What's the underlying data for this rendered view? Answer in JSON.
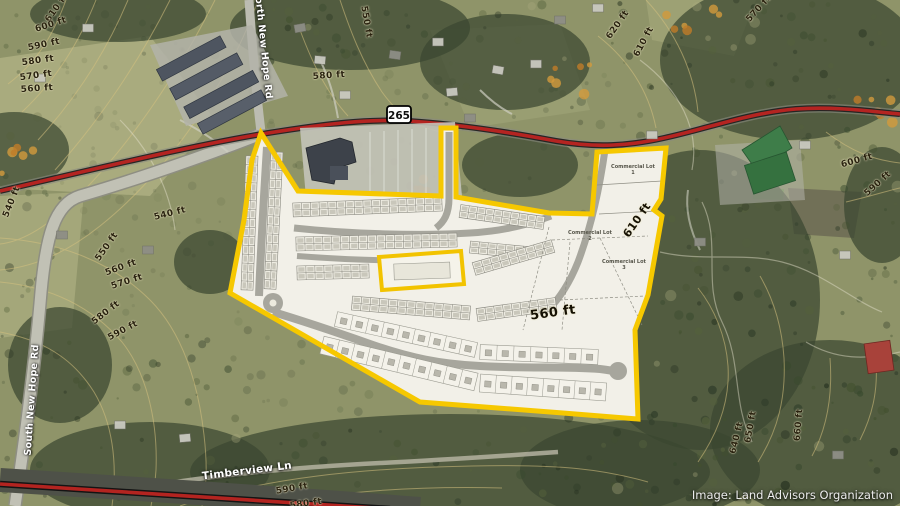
{
  "map": {
    "credit": "Image: Land Advisors Organization",
    "route_shield": {
      "number": "265"
    },
    "road_labels": [
      {
        "text": "North New Hope Rd",
        "x": 263,
        "y": 44,
        "rot": 84
      },
      {
        "text": "South New Hope Rd",
        "x": 32,
        "y": 400,
        "rot": -86
      },
      {
        "text": "Timberview Ln",
        "x": 247,
        "y": 471,
        "rot": -7,
        "size": 10.5
      }
    ],
    "elevation_labels": [
      {
        "text": "610 ft",
        "x": 57,
        "y": 8,
        "rot": -55
      },
      {
        "text": "600 ft",
        "x": 51,
        "y": 25,
        "rot": -18
      },
      {
        "text": "590 ft",
        "x": 44,
        "y": 45,
        "rot": -12
      },
      {
        "text": "580 ft",
        "x": 38,
        "y": 61,
        "rot": -8
      },
      {
        "text": "570 ft",
        "x": 36,
        "y": 76,
        "rot": -8
      },
      {
        "text": "560 ft",
        "x": 37,
        "y": 89,
        "rot": -4
      },
      {
        "text": "550 ft",
        "x": 366,
        "y": 22,
        "rot": 80
      },
      {
        "text": "580 ft",
        "x": 329,
        "y": 76,
        "rot": -4
      },
      {
        "text": "540 ft",
        "x": 12,
        "y": 202,
        "rot": -68
      },
      {
        "text": "540 ft",
        "x": 170,
        "y": 214,
        "rot": -14
      },
      {
        "text": "550 ft",
        "x": 107,
        "y": 247,
        "rot": -55
      },
      {
        "text": "560 ft",
        "x": 121,
        "y": 268,
        "rot": -20
      },
      {
        "text": "570 ft",
        "x": 127,
        "y": 282,
        "rot": -18
      },
      {
        "text": "580 ft",
        "x": 106,
        "y": 313,
        "rot": -38
      },
      {
        "text": "590 ft",
        "x": 123,
        "y": 331,
        "rot": -28
      },
      {
        "text": "620 ft",
        "x": 618,
        "y": 25,
        "rot": -55
      },
      {
        "text": "610 ft",
        "x": 644,
        "y": 42,
        "rot": -62
      },
      {
        "text": "570 ft",
        "x": 759,
        "y": 9,
        "rot": -48
      },
      {
        "text": "600 ft",
        "x": 857,
        "y": 161,
        "rot": -16
      },
      {
        "text": "590 ft",
        "x": 878,
        "y": 184,
        "rot": -42
      },
      {
        "text": "640 ft",
        "x": 737,
        "y": 438,
        "rot": -76
      },
      {
        "text": "650 ft",
        "x": 751,
        "y": 427,
        "rot": -80
      },
      {
        "text": "660 ft",
        "x": 799,
        "y": 425,
        "rot": -85
      },
      {
        "text": "610 ft",
        "x": 637,
        "y": 220,
        "rot": -55,
        "big": true,
        "size": 11
      },
      {
        "text": "560 ft",
        "x": 553,
        "y": 313,
        "rot": -8,
        "big": true,
        "size": 13
      },
      {
        "text": "590 ft",
        "x": 292,
        "y": 489,
        "rot": -10
      },
      {
        "text": "580 ft",
        "x": 306,
        "y": 504,
        "rot": -8
      }
    ],
    "parcel_labels": [
      {
        "text": "Commercial Lot 1",
        "x": 633,
        "y": 170
      },
      {
        "text": "Commercial Lot 2",
        "x": 590,
        "y": 236
      },
      {
        "text": "Commercial Lot 3",
        "x": 624,
        "y": 265
      }
    ]
  }
}
